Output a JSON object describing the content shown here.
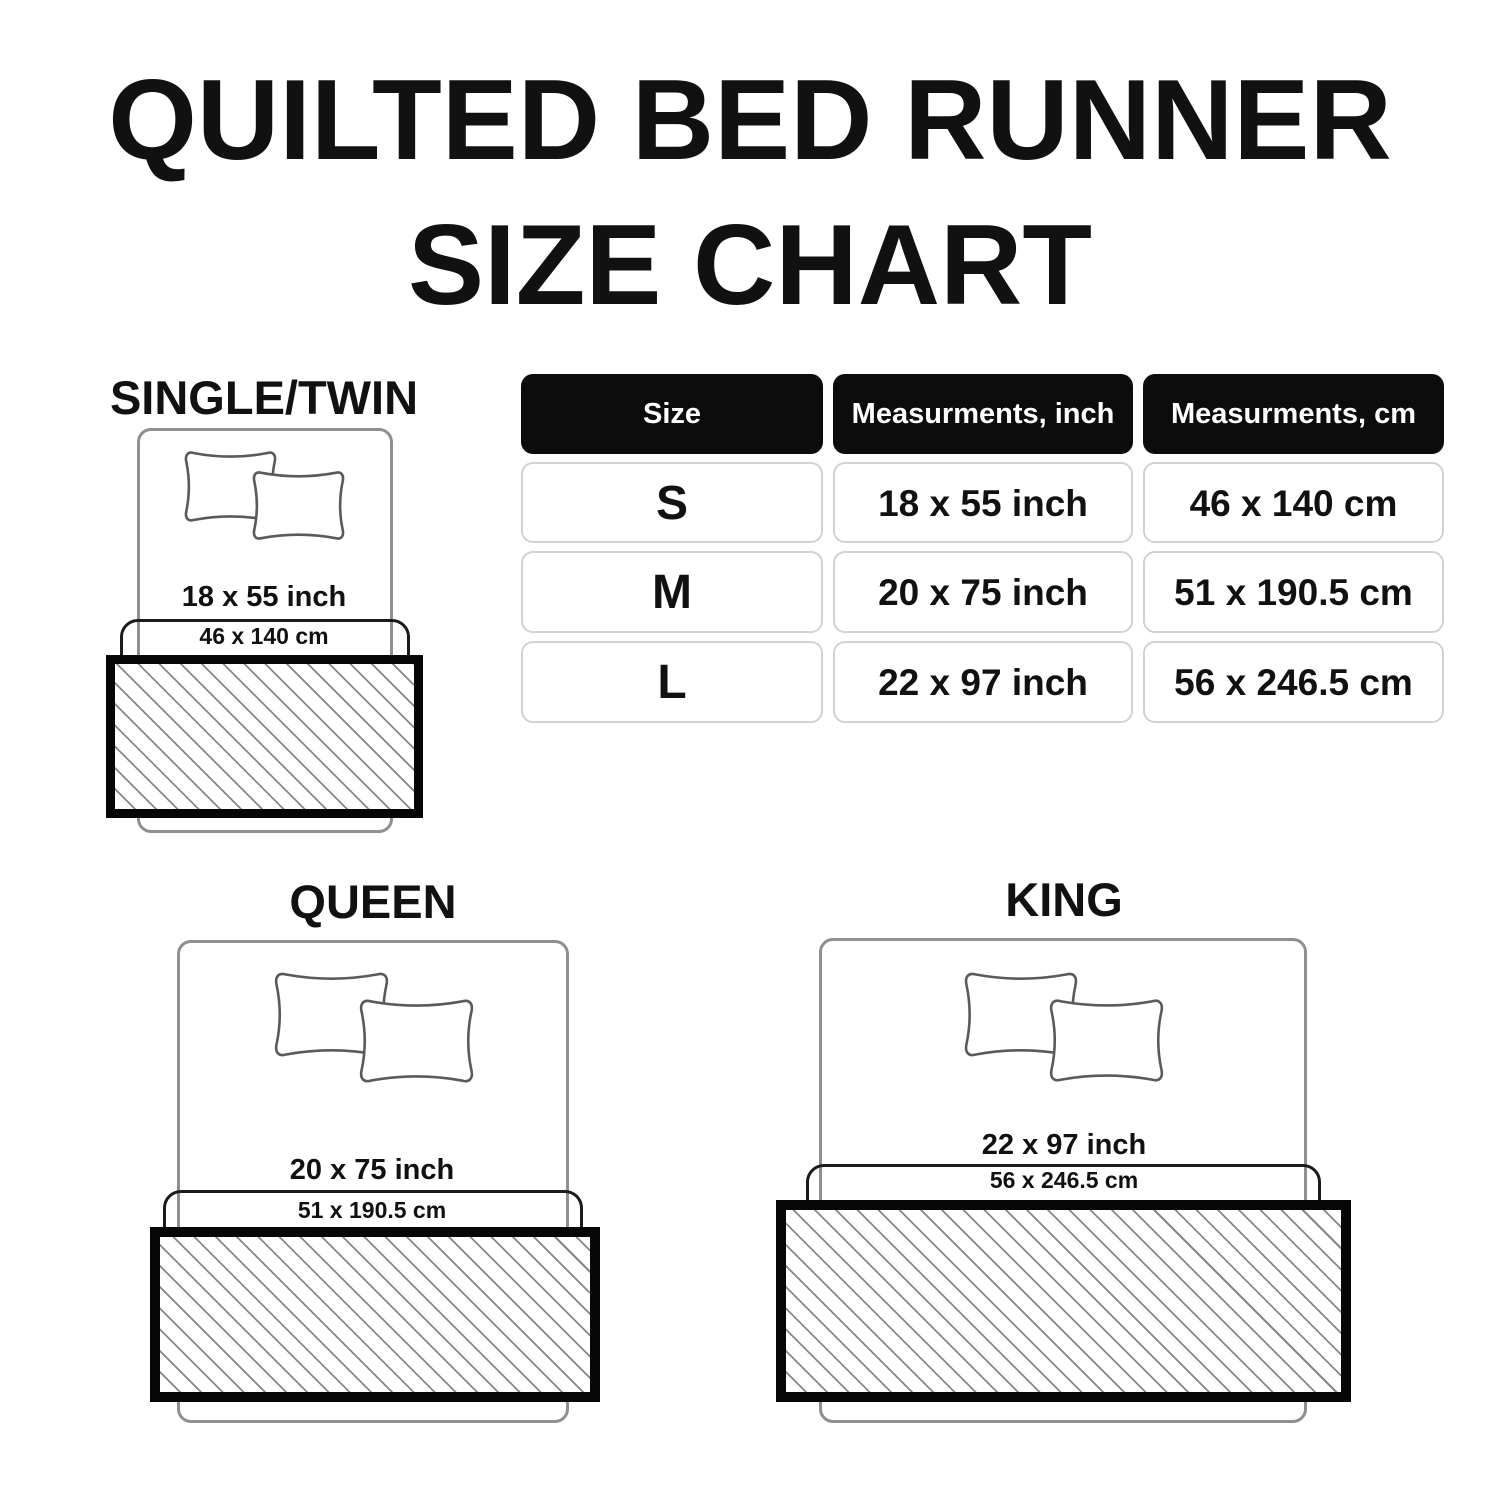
{
  "title": {
    "line1": "QUILTED BED RUNNER",
    "line2": "SIZE CHART"
  },
  "table": {
    "headers": [
      "Size",
      "Measurments, inch",
      "Measurments, cm"
    ],
    "rows": [
      {
        "size": "S",
        "inch": "18 x 55 inch",
        "cm": "46 x 140 cm"
      },
      {
        "size": "M",
        "inch": "20 x 75 inch",
        "cm": "51 x 190.5 cm"
      },
      {
        "size": "L",
        "inch": "22 x 97 inch",
        "cm": "56 x 246.5 cm"
      }
    ]
  },
  "diagrams": [
    {
      "name": "SINGLE/TWIN",
      "inch": "18 x 55 inch",
      "cm": "46 x 140 cm"
    },
    {
      "name": "QUEEN",
      "inch": "20 x 75 inch",
      "cm": "51 x 190.5 cm"
    },
    {
      "name": "KING",
      "inch": "22 x 97 inch",
      "cm": "56 x 246.5 cm"
    }
  ],
  "chart_data": {
    "type": "table",
    "title": "QUILTED BED RUNNER SIZE CHART",
    "columns": [
      "Size",
      "Measurments, inch",
      "Measurments, cm"
    ],
    "rows": [
      [
        "S",
        "18 x 55 inch",
        "46 x 140 cm"
      ],
      [
        "M",
        "20 x 75 inch",
        "51 x 190.5 cm"
      ],
      [
        "L",
        "22 x 97 inch",
        "56 x 246.5 cm"
      ]
    ]
  },
  "colors": {
    "ink": "#111111",
    "header-bg": "#0c0c0c",
    "header-text": "#ffffff",
    "cell-border": "#ccd5d2",
    "bed-line": "#8f8f8f",
    "pillow-line": "#5a5a5a",
    "outline-dark": "#1b1b1b",
    "runner-border": "#070707",
    "hatch-line": "#868686"
  }
}
